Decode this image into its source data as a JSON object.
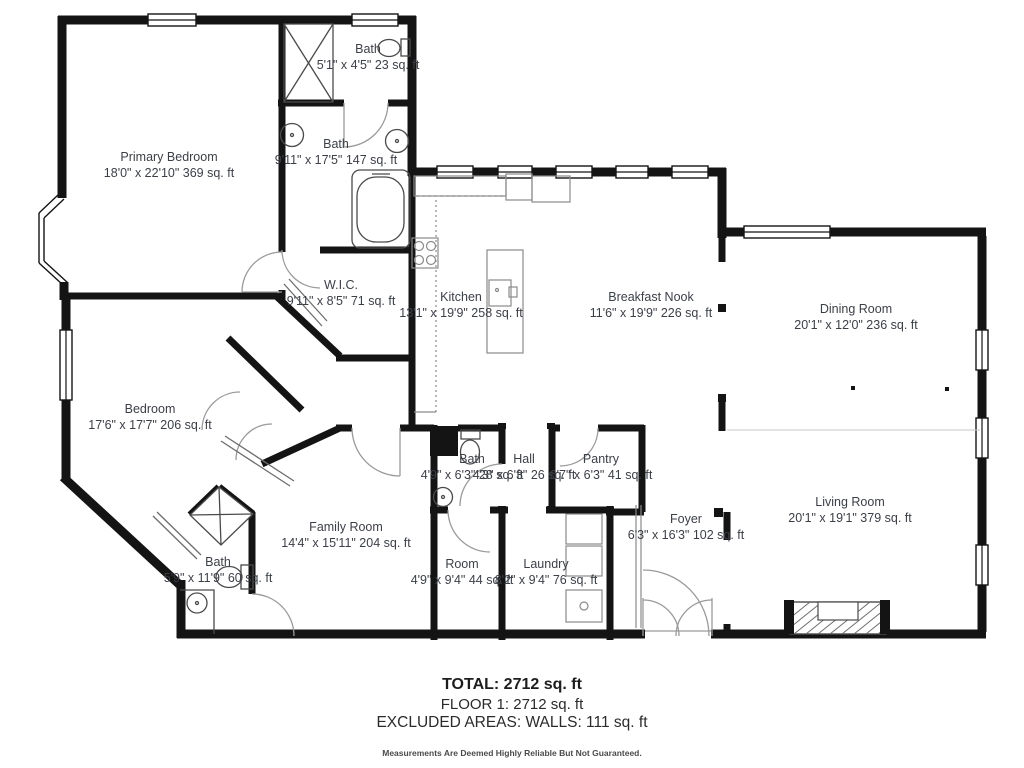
{
  "floorplan": {
    "rooms": [
      {
        "id": "primary-bedroom",
        "name": "Primary Bedroom",
        "dims": "18'0\" x 22'10\" 369 sq. ft"
      },
      {
        "id": "bath-top",
        "name": "Bath",
        "dims": "5'1\" x 4'5\" 23 sq. ft"
      },
      {
        "id": "bath-primary",
        "name": "Bath",
        "dims": "9'11\" x 17'5\" 147 sq. ft"
      },
      {
        "id": "wic",
        "name": "W.I.C.",
        "dims": "9'11\" x 8'5\" 71 sq. ft"
      },
      {
        "id": "kitchen",
        "name": "Kitchen",
        "dims": "13'1\" x 19'9\" 258 sq. ft"
      },
      {
        "id": "breakfast-nook",
        "name": "Breakfast Nook",
        "dims": "11'6\" x 19'9\" 226 sq. ft"
      },
      {
        "id": "dining-room",
        "name": "Dining Room",
        "dims": "20'1\" x 12'0\" 236 sq. ft"
      },
      {
        "id": "living-room",
        "name": "Living Room",
        "dims": "20'1\" x 19'1\" 379 sq. ft"
      },
      {
        "id": "bedroom",
        "name": "Bedroom",
        "dims": "17'6\" x 17'7\" 206 sq. ft"
      },
      {
        "id": "bath-lower",
        "name": "Bath",
        "dims": "5'9\" x 11'9\" 60 sq. ft"
      },
      {
        "id": "family-room",
        "name": "Family Room",
        "dims": "14'4\" x 15'11\" 204 sq. ft"
      },
      {
        "id": "bath-hall",
        "name": "Bath",
        "dims": "4'9\" x 6'3\" 28 sq. ft"
      },
      {
        "id": "hall",
        "name": "Hall",
        "dims": "4'3\" x 6'3\" 26 sq. ft"
      },
      {
        "id": "pantry",
        "name": "Pantry",
        "dims": "6'7\" x 6'3\" 41 sq. ft"
      },
      {
        "id": "room",
        "name": "Room",
        "dims": "4'9\" x 9'4\" 44 sq. ft"
      },
      {
        "id": "laundry",
        "name": "Laundry",
        "dims": "8'2\" x 9'4\" 76 sq. ft"
      },
      {
        "id": "foyer",
        "name": "Foyer",
        "dims": "6'3\" x 16'3\" 102 sq. ft"
      }
    ],
    "summary": {
      "total": "TOTAL: 2712 sq. ft",
      "floor": "FLOOR 1: 2712 sq. ft",
      "excluded": "EXCLUDED AREAS: WALLS: 111 sq. ft",
      "disclaimer": "Measurements Are Deemed Highly Reliable But Not Guaranteed."
    },
    "colors": {
      "wall": "#141414",
      "label": "#3b3f46",
      "door": "#9a9a9a",
      "fixture": "#4a4a4a"
    }
  }
}
